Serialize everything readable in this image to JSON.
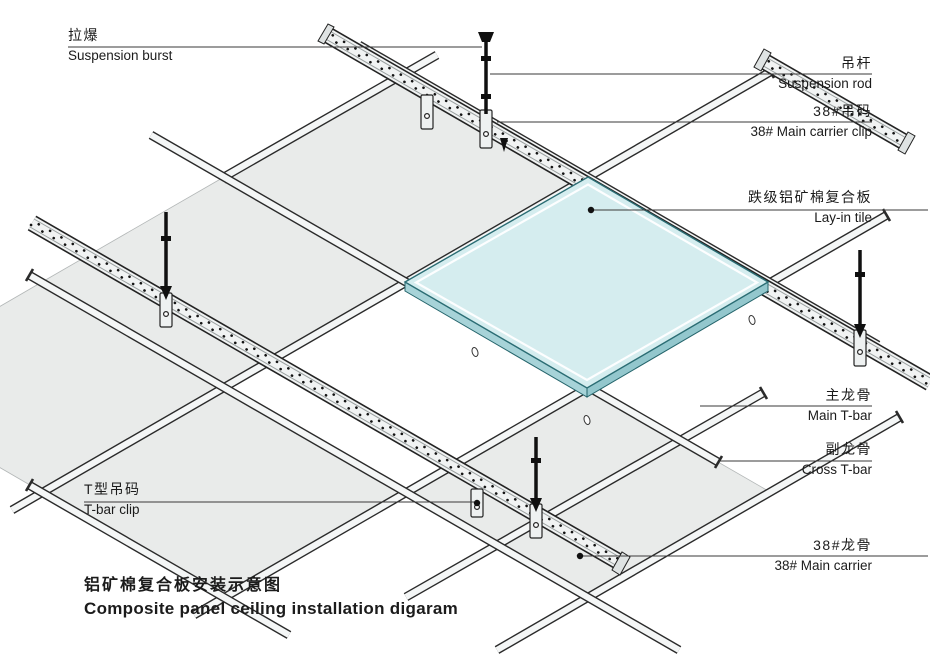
{
  "title": {
    "cn": "铝矿棉复合板安装示意图",
    "en": "Composite panel ceiling installation digaram"
  },
  "callouts": [
    {
      "id": "suspension-burst",
      "cn": "拉爆",
      "en": "Suspension burst"
    },
    {
      "id": "suspension-rod",
      "cn": "吊杆",
      "en": "Suspension rod"
    },
    {
      "id": "main-carrier-clip",
      "cn": "38#吊码",
      "en": "38# Main carrier clip"
    },
    {
      "id": "lay-in-tile",
      "cn": "跌级铝矿棉复合板",
      "en": "Lay-in tile"
    },
    {
      "id": "main-t-bar",
      "cn": "主龙骨",
      "en": "Main T-bar"
    },
    {
      "id": "cross-t-bar",
      "cn": "副龙骨",
      "en": "Cross T-bar"
    },
    {
      "id": "main-carrier-38",
      "cn": "38#龙骨",
      "en": "38# Main carrier"
    },
    {
      "id": "t-bar-clip",
      "cn": "T型吊码",
      "en": "T-bar clip"
    }
  ],
  "colors": {
    "tile_top": "#d5edef",
    "tile_side": "#9ccfd4",
    "panel_gray": "#e9ebea",
    "outline": "#2a2a2a",
    "leader": "#3a3a3a"
  },
  "diagram_type": "isometric suspended ceiling installation diagram"
}
